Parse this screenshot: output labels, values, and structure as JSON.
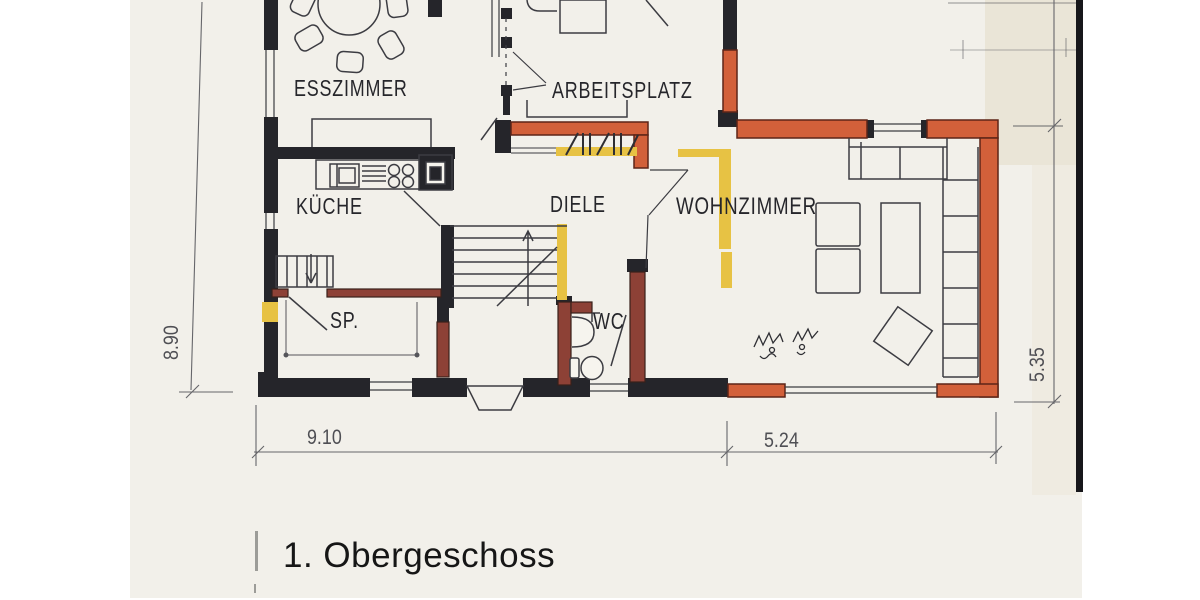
{
  "document": {
    "kind": "floor plan (photographed architectural drawing)",
    "floor_title": "1. Obergeschoss"
  },
  "rooms": [
    {
      "label": "ESSZIMMER"
    },
    {
      "label": "ARBEITSPLATZ"
    },
    {
      "label": "KÜCHE"
    },
    {
      "label": "DIELE"
    },
    {
      "label": "WOHNZIMMER"
    },
    {
      "label": "SP."
    },
    {
      "label": "WC"
    }
  ],
  "dimensions": {
    "left_height": "8.90",
    "bottom_main_width": "9.10",
    "bottom_annex_width": "5.24",
    "right_height": "5.35"
  },
  "colors": {
    "paper": "#f2f0ea",
    "wall_black": "#25252a",
    "wall_orange": "#d2603a",
    "wall_brick": "#8d4136",
    "highlight_yellow": "#e7c244"
  }
}
